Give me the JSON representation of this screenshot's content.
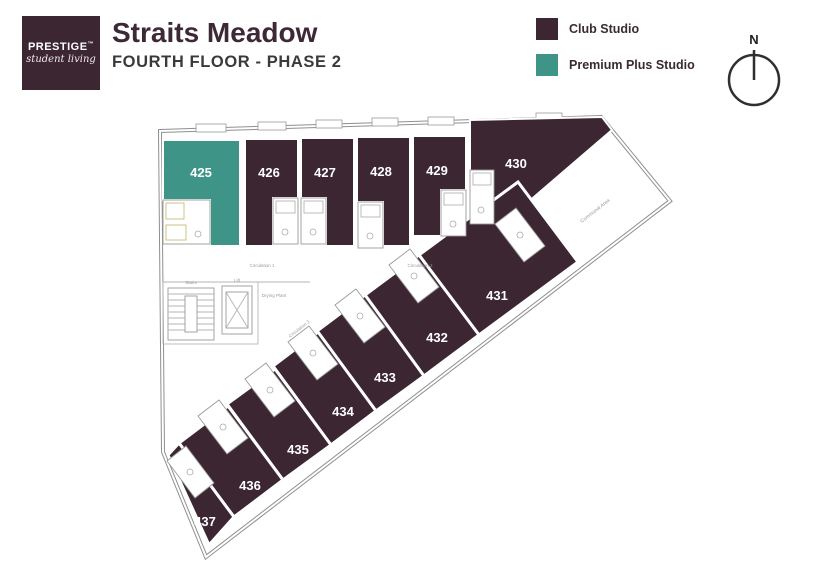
{
  "header": {
    "logo": {
      "brand": "PRESTIGE",
      "trademark": "TM",
      "tagline": "student living"
    },
    "title": "Straits Meadow",
    "subtitle": "FOURTH FLOOR - PHASE 2"
  },
  "legend": {
    "items": [
      {
        "label": "Club Studio",
        "color": "#3B2631"
      },
      {
        "label": "Premium Plus Studio",
        "color": "#3F9488"
      }
    ]
  },
  "compass": {
    "north_label": "N"
  },
  "floorplan": {
    "rooms": [
      {
        "number": "425",
        "type": "Premium Plus Studio"
      },
      {
        "number": "426",
        "type": "Club Studio"
      },
      {
        "number": "427",
        "type": "Club Studio"
      },
      {
        "number": "428",
        "type": "Club Studio"
      },
      {
        "number": "429",
        "type": "Club Studio"
      },
      {
        "number": "430",
        "type": "Club Studio"
      },
      {
        "number": "431",
        "type": "Club Studio"
      },
      {
        "number": "432",
        "type": "Club Studio"
      },
      {
        "number": "433",
        "type": "Club Studio"
      },
      {
        "number": "434",
        "type": "Club Studio"
      },
      {
        "number": "435",
        "type": "Club Studio"
      },
      {
        "number": "436",
        "type": "Club Studio"
      },
      {
        "number": "437",
        "type": "Club Studio"
      }
    ],
    "labels": {
      "circulation1": "Circulation 1",
      "circulation2": "Circulation 2",
      "circulation3": "Circulation 3",
      "stairs": "Stairs",
      "lift": "Lift",
      "drying_plant": "Drying Plant",
      "communal": "Communal Area"
    }
  }
}
